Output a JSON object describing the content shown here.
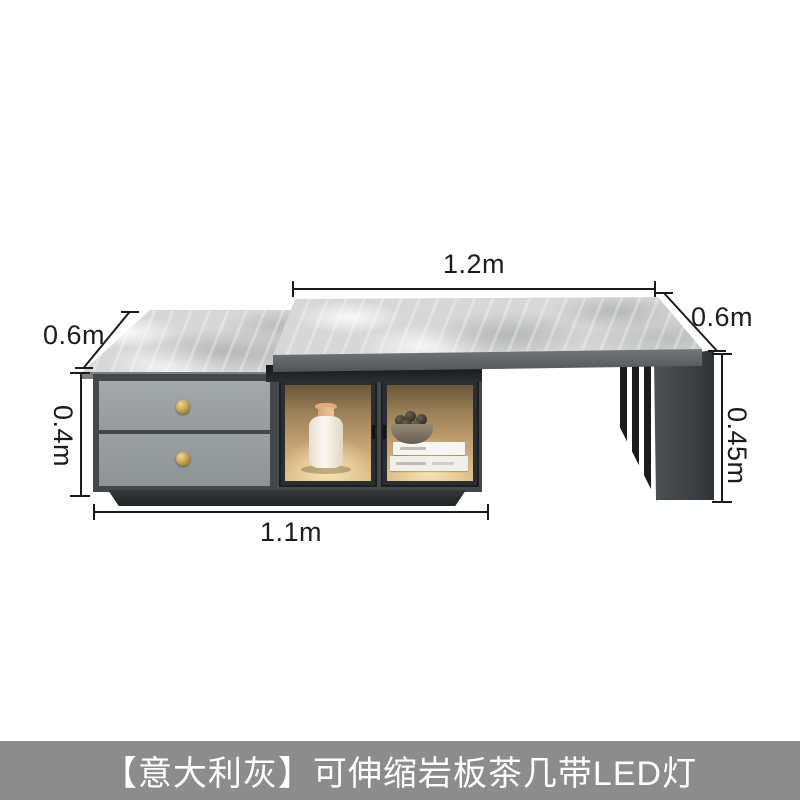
{
  "annotations": {
    "top_length": "1.2m",
    "top_depth": "0.6m",
    "base_depth": "0.6m",
    "chest_height": "0.4m",
    "leg_height": "0.45m",
    "chest_length": "1.1m"
  },
  "caption": {
    "text": "【意大利灰】可伸缩岩板茶几带LED灯",
    "bar_color": "#8c8c8c",
    "text_color": "#ffffff"
  },
  "scene": {
    "objects": [
      "upper-stone-top",
      "lower-stone-top",
      "drawer-chest",
      "glass-display-doors",
      "ceramic-vase",
      "decor-bowl",
      "stacked-books",
      "slatted-leg-panel"
    ],
    "colors": {
      "stone_top": "#d6d7d6",
      "cabinet_frame": "#4c5052",
      "drawer_front": "#9aa0a3",
      "knob_gold": "#c9a24e",
      "led_glow": "#dcbd89",
      "dimension_lines": "#1b1b1b"
    }
  }
}
